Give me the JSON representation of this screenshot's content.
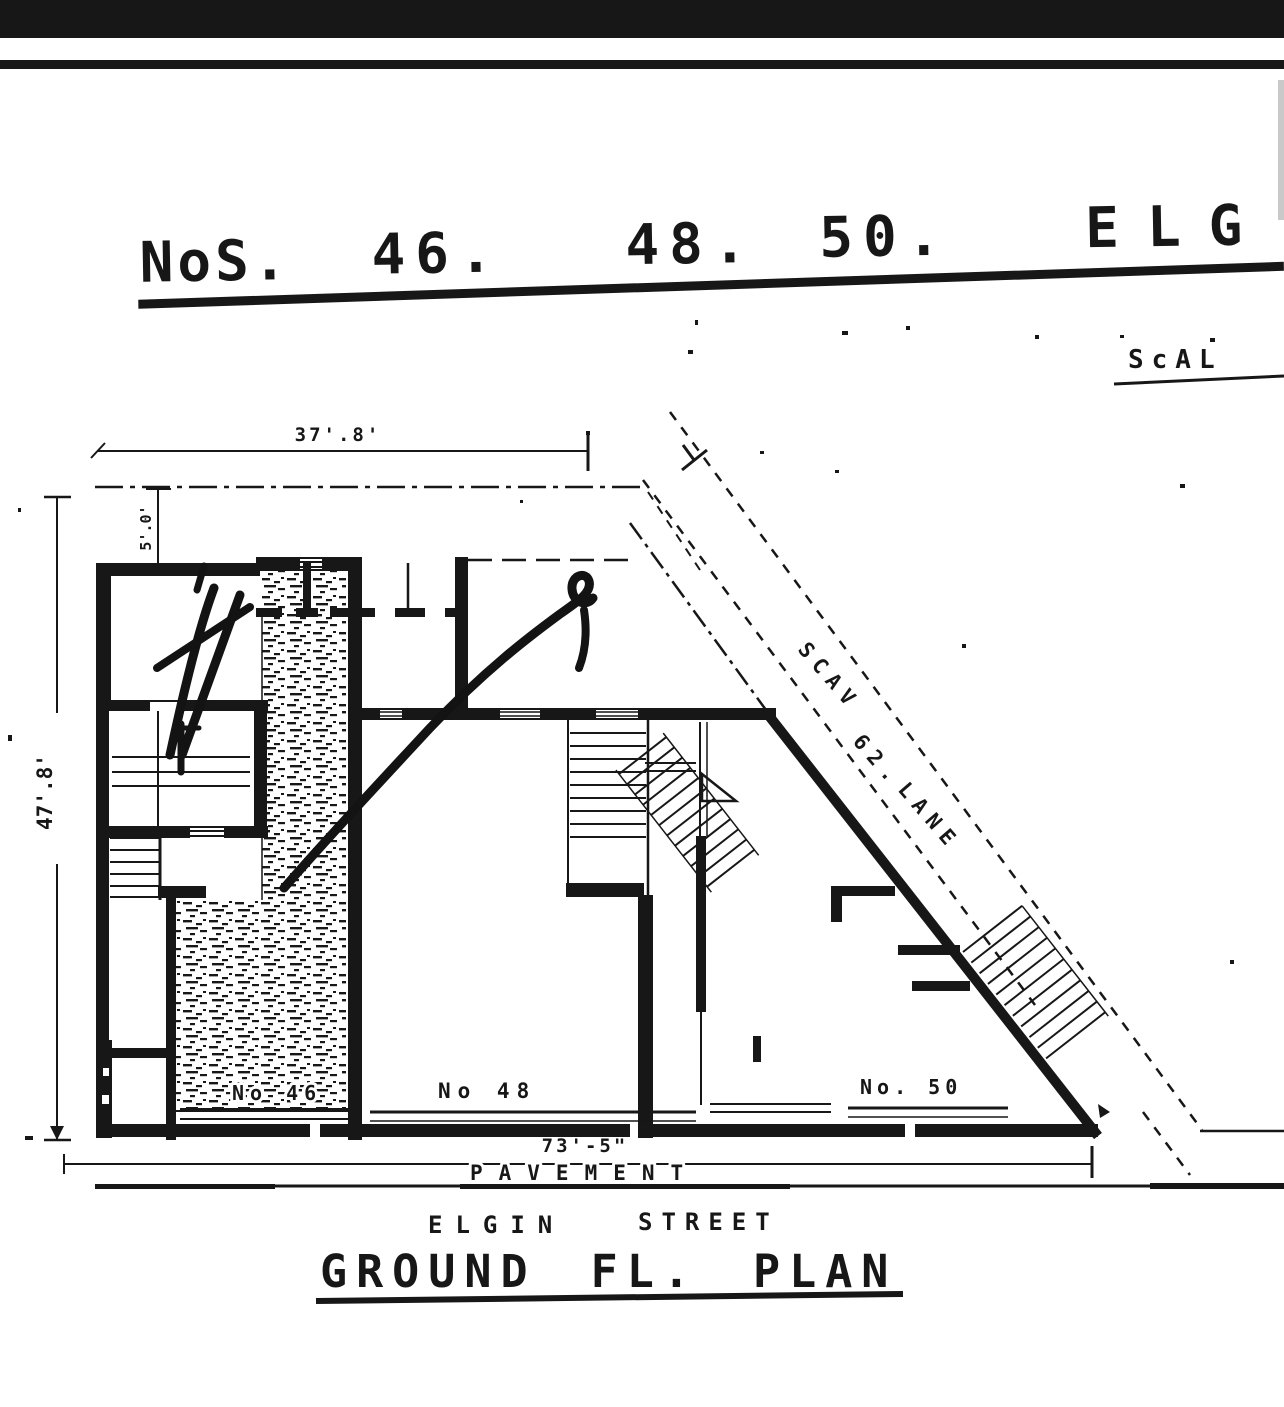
{
  "document": {
    "header_title": {
      "prefix": "NoS.",
      "no_1": "46.",
      "no_2": "48.",
      "no_3": "50.",
      "street_partial": "ELG"
    },
    "scale_label_partial": "ScAL",
    "plan_caption": "GROUND FL. PLAN"
  },
  "dimensions": {
    "frontage_top": "37'.8'",
    "setback_left": "5'.0'",
    "depth_left": "47'.8'",
    "frontage_bottom": "73'-5\""
  },
  "site_labels": {
    "lane_word_1": "SCAV",
    "lane_word_2": "62.",
    "lane_word_3": "LANE",
    "house_46": "No 46",
    "house_48": "No 48",
    "house_50": "No. 50",
    "pavement": "PAVEMENT",
    "street_word_1": "ELGIN",
    "street_word_2": "STREET"
  },
  "colors": {
    "ink": "#171717",
    "paper": "#ffffff"
  }
}
